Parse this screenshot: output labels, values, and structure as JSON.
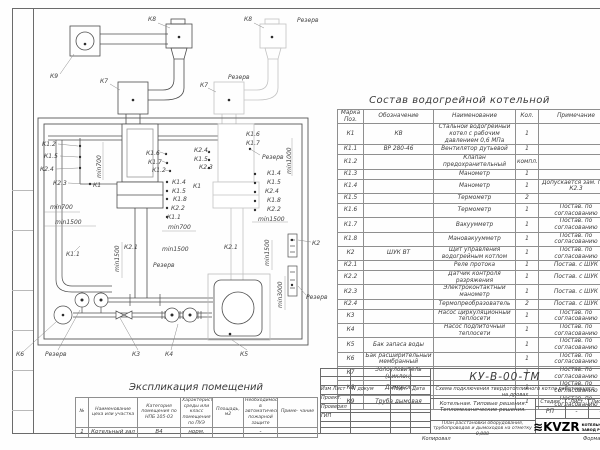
{
  "parts_table": {
    "title": "Состав водогрейной котельной",
    "headers": {
      "mark": "Марка Поз.",
      "designation": "Обозначение",
      "name": "Наименование",
      "qty": "Кол.",
      "note": "Примечание"
    },
    "rows": [
      [
        "К1",
        "КВ",
        "Стальной водогрейный котел с рабочим давлением 0,6 МПа",
        "1",
        ""
      ],
      [
        "К1.1",
        "ВР 280-46",
        "Вентилятор дутьевой",
        "1",
        ""
      ],
      [
        "К1.2",
        "",
        "Клапан предохранительный",
        "компл.",
        ""
      ],
      [
        "К1.3",
        "",
        "Манометр",
        "1",
        ""
      ],
      [
        "К1.4",
        "",
        "Манометр",
        "1",
        "Допускается зам. поз. К2.3"
      ],
      [
        "К1.5",
        "",
        "Термометр",
        "2",
        ""
      ],
      [
        "К1.6",
        "",
        "Термометр",
        "1",
        "Постав. по согласованию"
      ],
      [
        "К1.7",
        "",
        "Вакуумметр",
        "1",
        "Постав. по согласованию"
      ],
      [
        "К1.8",
        "",
        "Мановакуумметр",
        "1",
        "Постав. по согласованию"
      ],
      [
        "К2",
        "ШУК ВТ",
        "Щит управления водогрейным котлом",
        "1",
        "Постав. по согласованию"
      ],
      [
        "К2.1",
        "",
        "Реле протока",
        "1",
        "Постав. с ШУК"
      ],
      [
        "К2.2",
        "",
        "Датчик контроля разряжения",
        "1",
        "Постав. с ШУК"
      ],
      [
        "К2.3",
        "",
        "Электроконтактный манометр",
        "1",
        "Постав. с ШУК"
      ],
      [
        "К2.4",
        "",
        "Термопреобразователь",
        "2",
        "Постав. с ШУК"
      ],
      [
        "К3",
        "",
        "Насос циркуляционный теплосети",
        "1",
        "Постав. по согласованию"
      ],
      [
        "К4",
        "",
        "Насос подпиточный теплосети",
        "1",
        "Постав. по согласованию"
      ],
      [
        "К5",
        "Бак запаса воды",
        "",
        "1",
        "Постав. по согласованию"
      ],
      [
        "К6",
        "Бак расширительный мембранный",
        "",
        "1",
        "Постав. по согласованию"
      ],
      [
        "К7",
        "Золоуловитель (циклон)",
        "",
        "1",
        "Постав. по согласованию"
      ],
      [
        "К8",
        "Дымосос",
        "",
        "1",
        "Постав. по согласованию"
      ],
      [
        "К9",
        "Труба дымовая",
        "",
        "1",
        "Постав. по согласованию"
      ]
    ]
  },
  "explication": {
    "title": "Экспликация помещений",
    "headers": [
      "№",
      "Наименование цеха или участка",
      "Категория помещения по НПБ 105-03",
      "Характеристика среды или класс помещения по ПУЭ",
      "Площадь, м2",
      "Необходимость в автоматической пожарной защите",
      "Приме- чание"
    ],
    "row": [
      "1",
      "Котельный зал",
      "В4",
      "норм.",
      "",
      "-",
      ""
    ]
  },
  "title_block": {
    "doc_number": "КУ-В-00-ТМ",
    "scheme_title": "Схема подключения твердотопливного котла работающего на дровах",
    "section_title": "Котельная. Типовые решения. Тепломеханические решения.",
    "sheet_title": "План расстановки оборудования, трубопроводов и дымоходов на отметку 0,000",
    "col_izm": "Изм Лист",
    "col_doc": "N докум",
    "col_podp": "Подп.",
    "col_data": "Дата",
    "row1": "Проект.",
    "row2": "Проверил",
    "row3": "ГИП",
    "stage_label": "Стадия",
    "list_label": "Лист",
    "listov_label": "Листов",
    "stage_value": "РП",
    "list_value": "-",
    "listov_value": "-",
    "logo_wave": "≋",
    "logo_text": "KVZR",
    "company1": "КОТЕЛЬНЫЙ",
    "company2": "ЗАВОД РОССИИ",
    "copied": "Копировал",
    "format": "Формат"
  },
  "plan": {
    "labels": [
      {
        "t": "К9",
        "x": 50,
        "y": 78,
        "l": [
          60,
          74,
          74,
          54
        ]
      },
      {
        "t": "К8",
        "x": 148,
        "y": 21,
        "l": [
          158,
          23,
          170,
          28
        ]
      },
      {
        "t": "К7",
        "x": 100,
        "y": 83,
        "l": [
          110,
          84,
          120,
          90
        ]
      },
      {
        "t": "К8",
        "x": 244,
        "y": 21,
        "l": [
          254,
          23,
          264,
          28
        ]
      },
      {
        "t": "Резерв",
        "x": 297,
        "y": 22
      },
      {
        "t": "К7",
        "x": 200,
        "y": 87,
        "l": [
          208,
          88,
          216,
          92
        ]
      },
      {
        "t": "Резерв",
        "x": 228,
        "y": 79
      },
      {
        "t": "К1.2",
        "x": 42,
        "y": 146,
        "l": [
          58,
          144,
          78,
          146
        ]
      },
      {
        "t": "К1.5",
        "x": 44,
        "y": 158,
        "l": [
          60,
          156,
          78,
          157
        ]
      },
      {
        "t": "К2.4",
        "x": 40,
        "y": 171,
        "l": [
          56,
          169,
          78,
          168
        ]
      },
      {
        "t": "К2.3",
        "x": 53,
        "y": 185,
        "l": [
          68,
          183,
          88,
          184
        ]
      },
      {
        "t": "К1",
        "x": 93,
        "y": 187,
        "l": [
          101,
          184,
          116,
          184
        ]
      },
      {
        "t": "min700",
        "x": 101,
        "y": 178,
        "r": -90
      },
      {
        "t": "min700",
        "x": 50,
        "y": 209
      },
      {
        "t": "min1500",
        "x": 55,
        "y": 224
      },
      {
        "t": "К1.6",
        "x": 146,
        "y": 155,
        "l": [
          160,
          152,
          166,
          154
        ]
      },
      {
        "t": "К1.7",
        "x": 148,
        "y": 164,
        "l": [
          162,
          161,
          167,
          163
        ]
      },
      {
        "t": "К1.2",
        "x": 152,
        "y": 172,
        "l": [
          165,
          170,
          170,
          171
        ]
      },
      {
        "t": "К2.4",
        "x": 194,
        "y": 152,
        "l": [
          206,
          150,
          209,
          152
        ]
      },
      {
        "t": "К1.5",
        "x": 194,
        "y": 161
      },
      {
        "t": "К2.3",
        "x": 199,
        "y": 169
      },
      {
        "t": "К1.4",
        "x": 172,
        "y": 184
      },
      {
        "t": "К1",
        "x": 193,
        "y": 188
      },
      {
        "t": "К1.5",
        "x": 172,
        "y": 193
      },
      {
        "t": "К1.8",
        "x": 173,
        "y": 201
      },
      {
        "t": "К2.2",
        "x": 171,
        "y": 210
      },
      {
        "t": "К1.1",
        "x": 167,
        "y": 219
      },
      {
        "t": "min700",
        "x": 168,
        "y": 229
      },
      {
        "t": "К1.6",
        "x": 246,
        "y": 136
      },
      {
        "t": "К1.7",
        "x": 246,
        "y": 145
      },
      {
        "t": "Резерв",
        "x": 262,
        "y": 159,
        "l": [
          260,
          155,
          250,
          149
        ]
      },
      {
        "t": "min1000",
        "x": 291,
        "y": 174,
        "r": -90
      },
      {
        "t": "К1.4",
        "x": 267,
        "y": 175
      },
      {
        "t": "К1.5",
        "x": 267,
        "y": 184
      },
      {
        "t": "К2.4",
        "x": 265,
        "y": 193
      },
      {
        "t": "К1.8",
        "x": 267,
        "y": 202
      },
      {
        "t": "К2.2",
        "x": 267,
        "y": 211
      },
      {
        "t": "min1500",
        "x": 258,
        "y": 221
      },
      {
        "t": "К2.1",
        "x": 124,
        "y": 249
      },
      {
        "t": "К2.1",
        "x": 224,
        "y": 249
      },
      {
        "t": "min1500",
        "x": 162,
        "y": 251
      },
      {
        "t": "min1500",
        "x": 119,
        "y": 272,
        "r": -90
      },
      {
        "t": "min1500",
        "x": 269,
        "y": 266,
        "r": -90
      },
      {
        "t": "min3000",
        "x": 282,
        "y": 308,
        "r": -90
      },
      {
        "t": "Резерв",
        "x": 153,
        "y": 267
      },
      {
        "t": "К1.1",
        "x": 66,
        "y": 256,
        "l": [
          74,
          252,
          80,
          246
        ]
      },
      {
        "t": "К2",
        "x": 312,
        "y": 245,
        "l": [
          311,
          242,
          298,
          240
        ]
      },
      {
        "t": "Резерв",
        "x": 306,
        "y": 299,
        "l": [
          306,
          295,
          298,
          286
        ]
      },
      {
        "t": "К6",
        "x": 16,
        "y": 356,
        "l": [
          24,
          351,
          56,
          322
        ]
      },
      {
        "t": "Резерв",
        "x": 45,
        "y": 356,
        "l": [
          58,
          350,
          80,
          310
        ]
      },
      {
        "t": "К3",
        "x": 132,
        "y": 356,
        "l": [
          138,
          350,
          120,
          318
        ]
      },
      {
        "t": "К4",
        "x": 165,
        "y": 356,
        "l": [
          171,
          350,
          178,
          324
        ]
      },
      {
        "t": "К5",
        "x": 240,
        "y": 356,
        "l": [
          247,
          350,
          232,
          340
        ]
      }
    ]
  }
}
